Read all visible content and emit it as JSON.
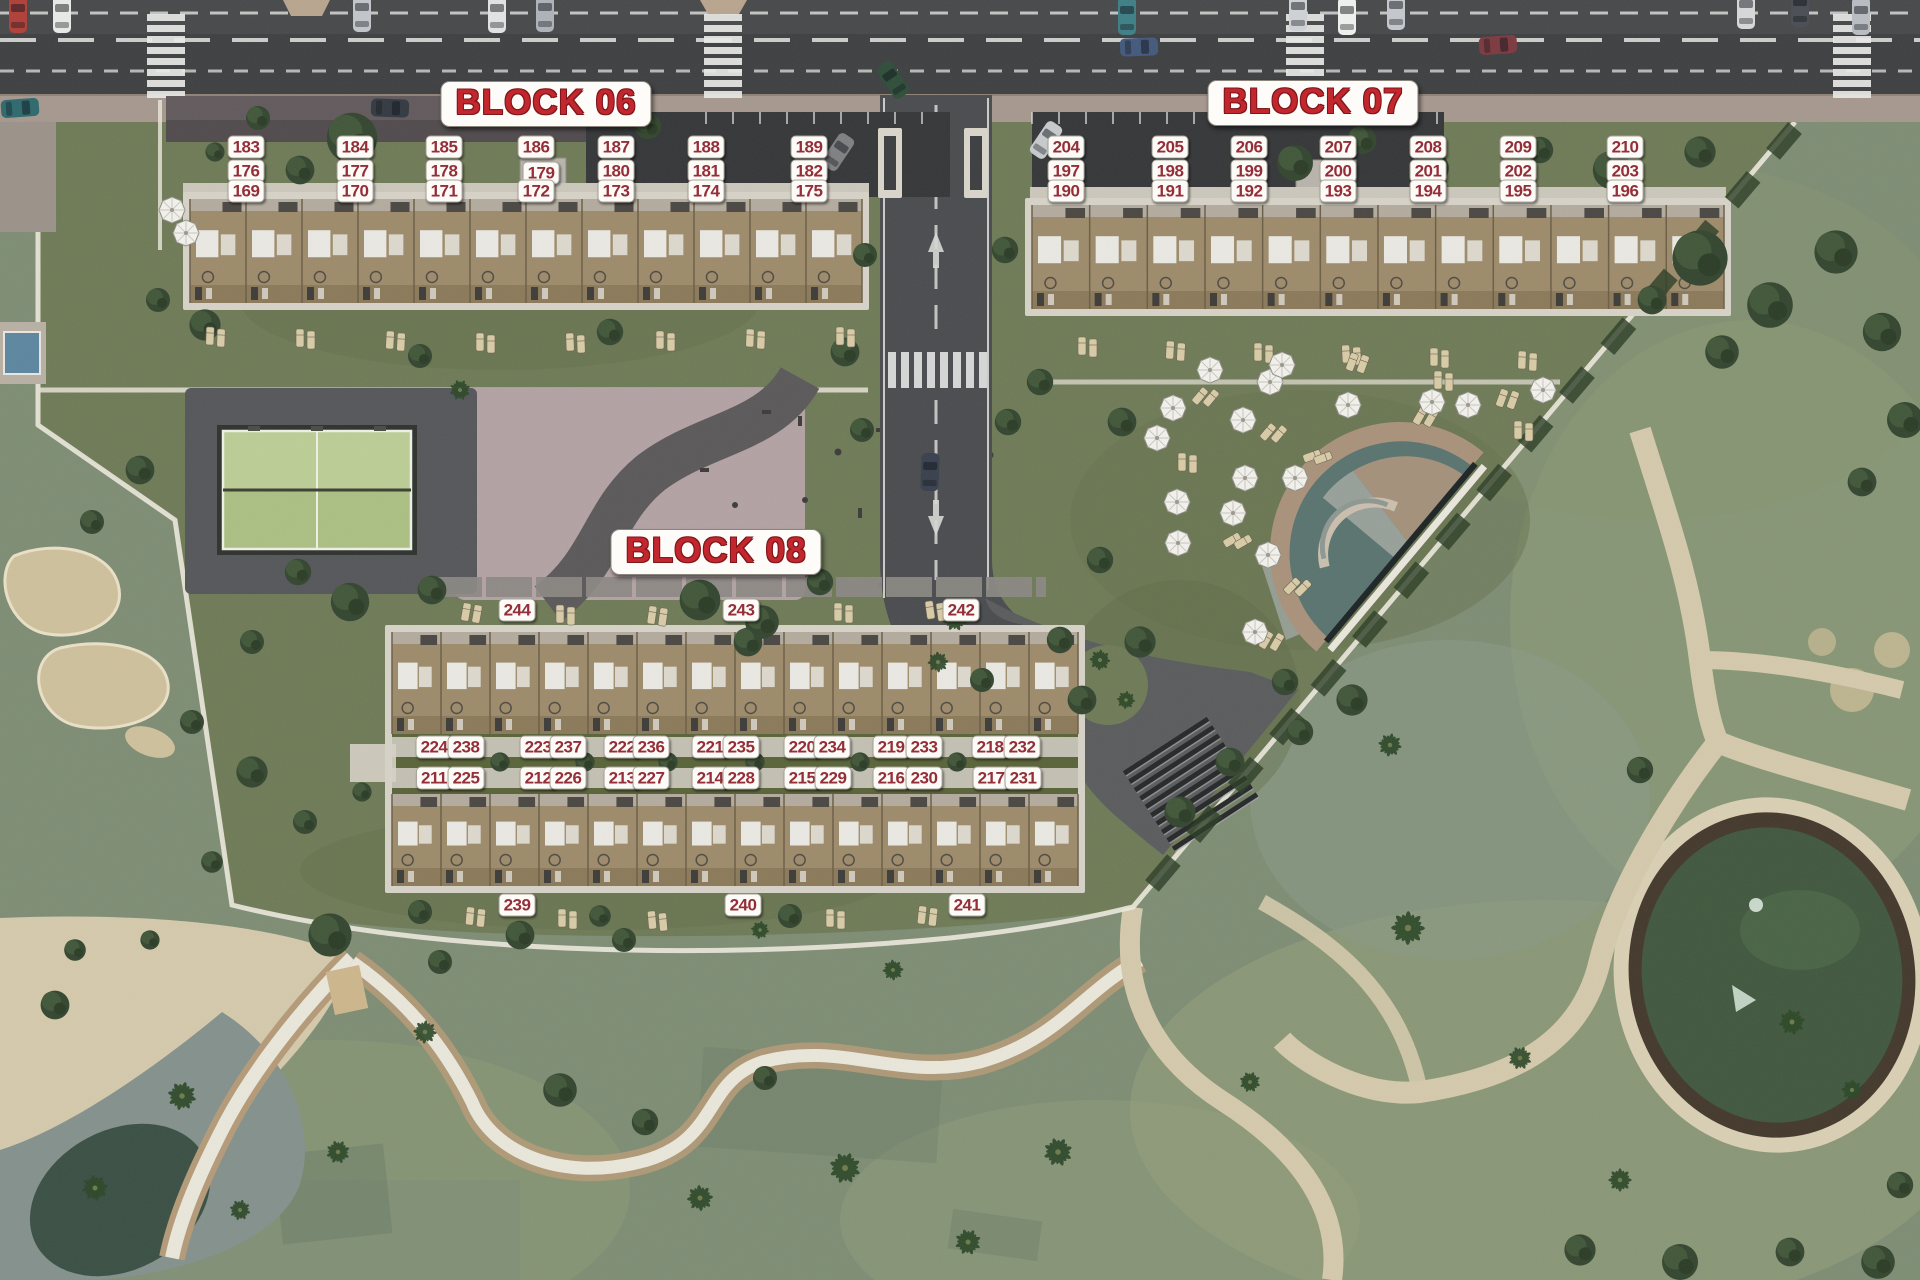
{
  "page": {
    "title": "Residential development site plan — Blocks 06, 07, 08"
  },
  "colors": {
    "label_text": "#942e38",
    "title_text": "#c1272c",
    "label_bg": "#fcfbf7"
  },
  "block_titles": [
    {
      "id": "block-06",
      "label": "BLOCK 06",
      "x": 546,
      "y": 104
    },
    {
      "id": "block-07",
      "label": "BLOCK 07",
      "x": 1313,
      "y": 103
    },
    {
      "id": "block-08",
      "label": "BLOCK 08",
      "x": 716,
      "y": 552
    }
  ],
  "unit_labels": [
    {
      "t": "183",
      "x": 246,
      "y": 147
    },
    {
      "t": "184",
      "x": 355,
      "y": 147
    },
    {
      "t": "185",
      "x": 444,
      "y": 147
    },
    {
      "t": "186",
      "x": 536,
      "y": 147
    },
    {
      "t": "187",
      "x": 616,
      "y": 147
    },
    {
      "t": "188",
      "x": 706,
      "y": 147
    },
    {
      "t": "189",
      "x": 809,
      "y": 147
    },
    {
      "t": "176",
      "x": 246,
      "y": 171
    },
    {
      "t": "177",
      "x": 355,
      "y": 171
    },
    {
      "t": "178",
      "x": 444,
      "y": 171
    },
    {
      "t": "179",
      "x": 541,
      "y": 173
    },
    {
      "t": "180",
      "x": 616,
      "y": 171
    },
    {
      "t": "181",
      "x": 706,
      "y": 171
    },
    {
      "t": "182",
      "x": 809,
      "y": 171
    },
    {
      "t": "169",
      "x": 246,
      "y": 191
    },
    {
      "t": "170",
      "x": 355,
      "y": 191
    },
    {
      "t": "171",
      "x": 444,
      "y": 191
    },
    {
      "t": "172",
      "x": 536,
      "y": 191
    },
    {
      "t": "173",
      "x": 616,
      "y": 191
    },
    {
      "t": "174",
      "x": 706,
      "y": 191
    },
    {
      "t": "175",
      "x": 809,
      "y": 191
    },
    {
      "t": "204",
      "x": 1066,
      "y": 147
    },
    {
      "t": "205",
      "x": 1170,
      "y": 147
    },
    {
      "t": "206",
      "x": 1249,
      "y": 147
    },
    {
      "t": "207",
      "x": 1338,
      "y": 147
    },
    {
      "t": "208",
      "x": 1428,
      "y": 147
    },
    {
      "t": "209",
      "x": 1518,
      "y": 147
    },
    {
      "t": "210",
      "x": 1625,
      "y": 147
    },
    {
      "t": "197",
      "x": 1066,
      "y": 171
    },
    {
      "t": "198",
      "x": 1170,
      "y": 171
    },
    {
      "t": "199",
      "x": 1249,
      "y": 171
    },
    {
      "t": "200",
      "x": 1338,
      "y": 171
    },
    {
      "t": "201",
      "x": 1428,
      "y": 171
    },
    {
      "t": "202",
      "x": 1518,
      "y": 171
    },
    {
      "t": "203",
      "x": 1625,
      "y": 171
    },
    {
      "t": "190",
      "x": 1066,
      "y": 191
    },
    {
      "t": "191",
      "x": 1170,
      "y": 191
    },
    {
      "t": "192",
      "x": 1249,
      "y": 191
    },
    {
      "t": "193",
      "x": 1338,
      "y": 191
    },
    {
      "t": "194",
      "x": 1428,
      "y": 191
    },
    {
      "t": "195",
      "x": 1518,
      "y": 191
    },
    {
      "t": "196",
      "x": 1625,
      "y": 191
    },
    {
      "t": "244",
      "x": 517,
      "y": 610
    },
    {
      "t": "243",
      "x": 741,
      "y": 610
    },
    {
      "t": "242",
      "x": 961,
      "y": 610
    },
    {
      "t": "224",
      "x": 434,
      "y": 747
    },
    {
      "t": "238",
      "x": 466,
      "y": 747
    },
    {
      "t": "223",
      "x": 538,
      "y": 747
    },
    {
      "t": "237",
      "x": 568,
      "y": 747
    },
    {
      "t": "222",
      "x": 622,
      "y": 747
    },
    {
      "t": "236",
      "x": 651,
      "y": 747
    },
    {
      "t": "221",
      "x": 710,
      "y": 747
    },
    {
      "t": "235",
      "x": 741,
      "y": 747
    },
    {
      "t": "220",
      "x": 802,
      "y": 747
    },
    {
      "t": "234",
      "x": 832,
      "y": 747
    },
    {
      "t": "219",
      "x": 891,
      "y": 747
    },
    {
      "t": "233",
      "x": 924,
      "y": 747
    },
    {
      "t": "218",
      "x": 990,
      "y": 747
    },
    {
      "t": "232",
      "x": 1022,
      "y": 747
    },
    {
      "t": "211",
      "x": 434,
      "y": 778
    },
    {
      "t": "225",
      "x": 466,
      "y": 778
    },
    {
      "t": "212",
      "x": 538,
      "y": 778
    },
    {
      "t": "226",
      "x": 568,
      "y": 778
    },
    {
      "t": "213",
      "x": 622,
      "y": 778
    },
    {
      "t": "227",
      "x": 651,
      "y": 778
    },
    {
      "t": "214",
      "x": 710,
      "y": 778
    },
    {
      "t": "228",
      "x": 741,
      "y": 778
    },
    {
      "t": "215",
      "x": 802,
      "y": 778
    },
    {
      "t": "229",
      "x": 833,
      "y": 778
    },
    {
      "t": "216",
      "x": 891,
      "y": 778
    },
    {
      "t": "230",
      "x": 924,
      "y": 778
    },
    {
      "t": "217",
      "x": 991,
      "y": 778
    },
    {
      "t": "231",
      "x": 1023,
      "y": 778
    },
    {
      "t": "239",
      "x": 517,
      "y": 905
    },
    {
      "t": "240",
      "x": 743,
      "y": 905
    },
    {
      "t": "241",
      "x": 967,
      "y": 905
    }
  ],
  "scenery": {
    "buildings": [
      {
        "x": 190,
        "y": 199,
        "w": 672,
        "h": 104,
        "u": 56
      },
      {
        "x": 1032,
        "y": 205,
        "w": 692,
        "h": 104,
        "u": 57.66
      },
      {
        "x": 392,
        "y": 632,
        "w": 686,
        "h": 102,
        "u": 49
      },
      {
        "x": 392,
        "y": 794,
        "w": 686,
        "h": 92,
        "u": 49
      }
    ],
    "crosswalks": [
      147,
      704,
      1286,
      1833
    ],
    "umbrellas": [
      [
        1173,
        408
      ],
      [
        1243,
        420
      ],
      [
        1157,
        438
      ],
      [
        1348,
        405
      ],
      [
        1432,
        402
      ],
      [
        1468,
        405
      ],
      [
        1543,
        390
      ],
      [
        1270,
        382
      ],
      [
        1210,
        370
      ],
      [
        1282,
        365
      ],
      [
        1245,
        478
      ],
      [
        1295,
        478
      ],
      [
        1177,
        502
      ],
      [
        1233,
        513
      ],
      [
        1178,
        543
      ],
      [
        1268,
        555
      ],
      [
        1255,
        632
      ],
      [
        172,
        210
      ],
      [
        186,
        233
      ]
    ],
    "palms": [
      [
        955,
        618,
        1
      ],
      [
        938,
        662,
        0.8
      ],
      [
        845,
        1168,
        1.2
      ],
      [
        1058,
        1152,
        1.1
      ],
      [
        700,
        1198,
        1
      ],
      [
        425,
        1032,
        0.9
      ],
      [
        182,
        1096,
        1.1
      ],
      [
        95,
        1188,
        1
      ],
      [
        1408,
        928,
        1.3
      ],
      [
        1520,
        1058,
        0.9
      ],
      [
        1250,
        1082,
        0.8
      ],
      [
        968,
        1242,
        1
      ],
      [
        1792,
        1022,
        1
      ],
      [
        1852,
        1090,
        0.8
      ],
      [
        338,
        1152,
        0.9
      ],
      [
        240,
        1210,
        0.8
      ],
      [
        1390,
        745,
        0.9
      ],
      [
        893,
        970,
        0.8
      ],
      [
        1620,
        1180,
        0.9
      ],
      [
        1100,
        660,
        0.8
      ],
      [
        1126,
        700,
        0.7
      ],
      [
        460,
        390,
        0.8
      ],
      [
        760,
        930,
        0.7
      ]
    ],
    "trees": [
      [
        352,
        138,
        2.1
      ],
      [
        300,
        170,
        1.2
      ],
      [
        258,
        118,
        1
      ],
      [
        455,
        118,
        0.9
      ],
      [
        648,
        126,
        1.1
      ],
      [
        215,
        152,
        0.8
      ],
      [
        1295,
        163,
        1.5
      ],
      [
        1362,
        140,
        1.2
      ],
      [
        1432,
        168,
        1.4
      ],
      [
        1540,
        150,
        1.1
      ],
      [
        1612,
        170,
        1.6
      ],
      [
        1700,
        152,
        1.3
      ],
      [
        205,
        325,
        1.3
      ],
      [
        420,
        356,
        1
      ],
      [
        610,
        332,
        1.1
      ],
      [
        845,
        352,
        1.2
      ],
      [
        158,
        300,
        1
      ],
      [
        865,
        255,
        1
      ],
      [
        1005,
        250,
        1.1
      ],
      [
        862,
        430,
        1
      ],
      [
        1008,
        422,
        1.1
      ],
      [
        1040,
        382,
        1.1
      ],
      [
        1122,
        422,
        1.2
      ],
      [
        1100,
        560,
        1.1
      ],
      [
        1140,
        642,
        1.3
      ],
      [
        1082,
        700,
        1.2
      ],
      [
        1285,
        682,
        1.1
      ],
      [
        1352,
        700,
        1.3
      ],
      [
        1300,
        732,
        1.1
      ],
      [
        1230,
        762,
        1.2
      ],
      [
        1180,
        812,
        1.3
      ],
      [
        350,
        602,
        1.6
      ],
      [
        298,
        572,
        1.1
      ],
      [
        432,
        590,
        1.2
      ],
      [
        252,
        642,
        1
      ],
      [
        762,
        622,
        1.4
      ],
      [
        820,
        582,
        1.1
      ],
      [
        700,
        600,
        1.7
      ],
      [
        748,
        642,
        1.2
      ],
      [
        1060,
        640,
        1.1
      ],
      [
        982,
        680,
        1
      ],
      [
        420,
        912,
        1
      ],
      [
        600,
        916,
        0.9
      ],
      [
        790,
        916,
        1
      ],
      [
        330,
        935,
        1.8
      ],
      [
        440,
        962,
        1
      ],
      [
        520,
        935,
        1.2
      ],
      [
        624,
        940,
        1
      ],
      [
        560,
        1090,
        1.4
      ],
      [
        645,
        1122,
        1.1
      ],
      [
        765,
        1078,
        1
      ],
      [
        1700,
        258,
        2.3
      ],
      [
        1770,
        305,
        1.9
      ],
      [
        1836,
        252,
        1.8
      ],
      [
        1882,
        332,
        1.6
      ],
      [
        1722,
        352,
        1.4
      ],
      [
        1652,
        300,
        1.2
      ],
      [
        1905,
        420,
        1.5
      ],
      [
        1862,
        482,
        1.2
      ],
      [
        1640,
        770,
        1.1
      ],
      [
        1580,
        1250,
        1.3
      ],
      [
        1680,
        1262,
        1.5
      ],
      [
        1790,
        1252,
        1.2
      ],
      [
        1878,
        1262,
        1.4
      ],
      [
        1900,
        1185,
        1.1
      ],
      [
        140,
        470,
        1.2
      ],
      [
        92,
        522,
        1
      ],
      [
        192,
        722,
        1
      ],
      [
        252,
        772,
        1.3
      ],
      [
        305,
        822,
        1
      ],
      [
        362,
        792,
        0.8
      ],
      [
        212,
        862,
        0.9
      ],
      [
        55,
        1005,
        1.2
      ],
      [
        75,
        950,
        0.9
      ],
      [
        150,
        940,
        0.8
      ]
    ],
    "yardtrees": [
      [
        500,
        762
      ],
      [
        585,
        762
      ],
      [
        668,
        762
      ],
      [
        755,
        762
      ],
      [
        860,
        762
      ],
      [
        957,
        762
      ]
    ],
    "cars": [
      {
        "x": 18,
        "y": 14,
        "r": 0,
        "c": "#b04038"
      },
      {
        "x": 62,
        "y": 14,
        "r": 0,
        "c": "#e9e9e7"
      },
      {
        "x": 362,
        "y": 13,
        "r": 0,
        "c": "#c2c6ca"
      },
      {
        "x": 497,
        "y": 14,
        "r": 0,
        "c": "#e2e3e4"
      },
      {
        "x": 545,
        "y": 13,
        "r": 0,
        "c": "#aeb3b9"
      },
      {
        "x": 1298,
        "y": 12,
        "r": 0,
        "c": "#cfd2d5"
      },
      {
        "x": 1347,
        "y": 16,
        "r": 0,
        "c": "#f0f0ee"
      },
      {
        "x": 1396,
        "y": 11,
        "r": 0,
        "c": "#c4c8cc"
      },
      {
        "x": 1746,
        "y": 10,
        "r": 0,
        "c": "#d6d8da"
      },
      {
        "x": 1800,
        "y": 8,
        "r": 0,
        "c": "#4a4e54"
      },
      {
        "x": 1861,
        "y": 16,
        "r": 0,
        "c": "#b9bdc2"
      },
      {
        "x": 20,
        "y": 108,
        "r": 86,
        "c": "#2e6a6e"
      },
      {
        "x": 390,
        "y": 108,
        "r": 92,
        "c": "#343a42"
      },
      {
        "x": 893,
        "y": 80,
        "r": -34,
        "c": "#2f4e3a"
      },
      {
        "x": 1139,
        "y": 47,
        "r": 88,
        "c": "#44597c"
      },
      {
        "x": 1498,
        "y": 45,
        "r": 86,
        "c": "#7c3a40"
      },
      {
        "x": 1127,
        "y": 16,
        "r": 0,
        "c": "#3f7f86"
      },
      {
        "x": 838,
        "y": 152,
        "r": 34,
        "c": "#7e8082"
      },
      {
        "x": 1046,
        "y": 140,
        "r": 34,
        "c": "#c7cacd"
      },
      {
        "x": 930,
        "y": 472,
        "r": 2,
        "c": "#39414f"
      }
    ],
    "loungers": [
      [
        210,
        336,
        2
      ],
      [
        300,
        338,
        0
      ],
      [
        390,
        340,
        3
      ],
      [
        480,
        342,
        0
      ],
      [
        570,
        342,
        -2
      ],
      [
        660,
        340,
        0
      ],
      [
        750,
        338,
        2
      ],
      [
        840,
        336,
        0
      ],
      [
        1082,
        346,
        0
      ],
      [
        1170,
        350,
        3
      ],
      [
        1258,
        352,
        0
      ],
      [
        1346,
        354,
        -3
      ],
      [
        1434,
        357,
        0
      ],
      [
        1522,
        360,
        2
      ],
      [
        466,
        612,
        10
      ],
      [
        560,
        614,
        0
      ],
      [
        652,
        615,
        8
      ],
      [
        838,
        612,
        0
      ],
      [
        930,
        610,
        -8
      ],
      [
        470,
        916,
        5
      ],
      [
        562,
        918,
        0
      ],
      [
        652,
        920,
        -5
      ],
      [
        830,
        918,
        0
      ],
      [
        922,
        915,
        6
      ],
      [
        1200,
        396,
        40
      ],
      [
        1268,
        432,
        40
      ],
      [
        1182,
        462,
        0
      ],
      [
        1312,
        456,
        70
      ],
      [
        1420,
        416,
        30
      ],
      [
        1502,
        398,
        20
      ],
      [
        1232,
        540,
        60
      ],
      [
        1292,
        586,
        45
      ],
      [
        1266,
        640,
        30
      ],
      [
        1438,
        380,
        0
      ],
      [
        1352,
        362,
        20
      ],
      [
        1518,
        430,
        0
      ]
    ],
    "canopy_array": {
      "cx": 1192,
      "cy": 786,
      "rot": -33,
      "bars": 10,
      "len": 100,
      "gap": 10
    }
  }
}
